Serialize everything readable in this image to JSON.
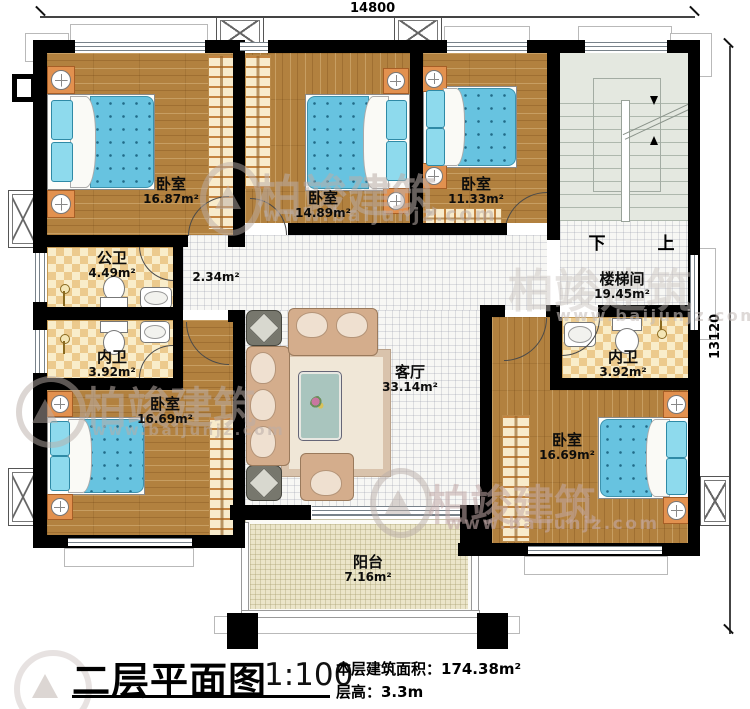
{
  "dimensions": {
    "width": "14800",
    "height": "13120"
  },
  "rooms": [
    {
      "id": "bedroom-1",
      "name": "卧室",
      "area": "16.87m²"
    },
    {
      "id": "bedroom-2",
      "name": "卧室",
      "area": "14.89m²"
    },
    {
      "id": "bedroom-3",
      "name": "卧室",
      "area": "11.33m²"
    },
    {
      "id": "stairwell",
      "name": "楼梯间",
      "area": "19.45m²"
    },
    {
      "id": "bath-public",
      "name": "公卫",
      "area": "4.49m²"
    },
    {
      "id": "bath-inner-left",
      "name": "内卫",
      "area": "3.92m²"
    },
    {
      "id": "bath-inner-right",
      "name": "内卫",
      "area": "3.92m²"
    },
    {
      "id": "living-room",
      "name": "客厅",
      "area": "33.14m²"
    },
    {
      "id": "bedroom-4",
      "name": "卧室",
      "area": "16.69m²"
    },
    {
      "id": "bedroom-5",
      "name": "卧室",
      "area": "16.69m²"
    },
    {
      "id": "balcony",
      "name": "阳台",
      "area": "7.16m²"
    },
    {
      "id": "hallway",
      "name": "",
      "area": "2.34m²"
    }
  ],
  "stairs": {
    "down": "下",
    "up": "上"
  },
  "title": {
    "text": "二层平面图",
    "scale": "1:100",
    "stats_area": "本层建筑面积：174.38m²",
    "stats_height": "层高：3.3m"
  },
  "watermark": {
    "brand": "柏竣建筑",
    "url": "www.baijunjz.com"
  },
  "colors": {
    "wall": "#000000",
    "wood_floor": "#b2813f",
    "bath_tile": "#eccb8e",
    "bed": "#67c3e0",
    "stairs": "#e4e8e0",
    "balcony": "#ebe5c9",
    "watermark": "#baada8"
  }
}
